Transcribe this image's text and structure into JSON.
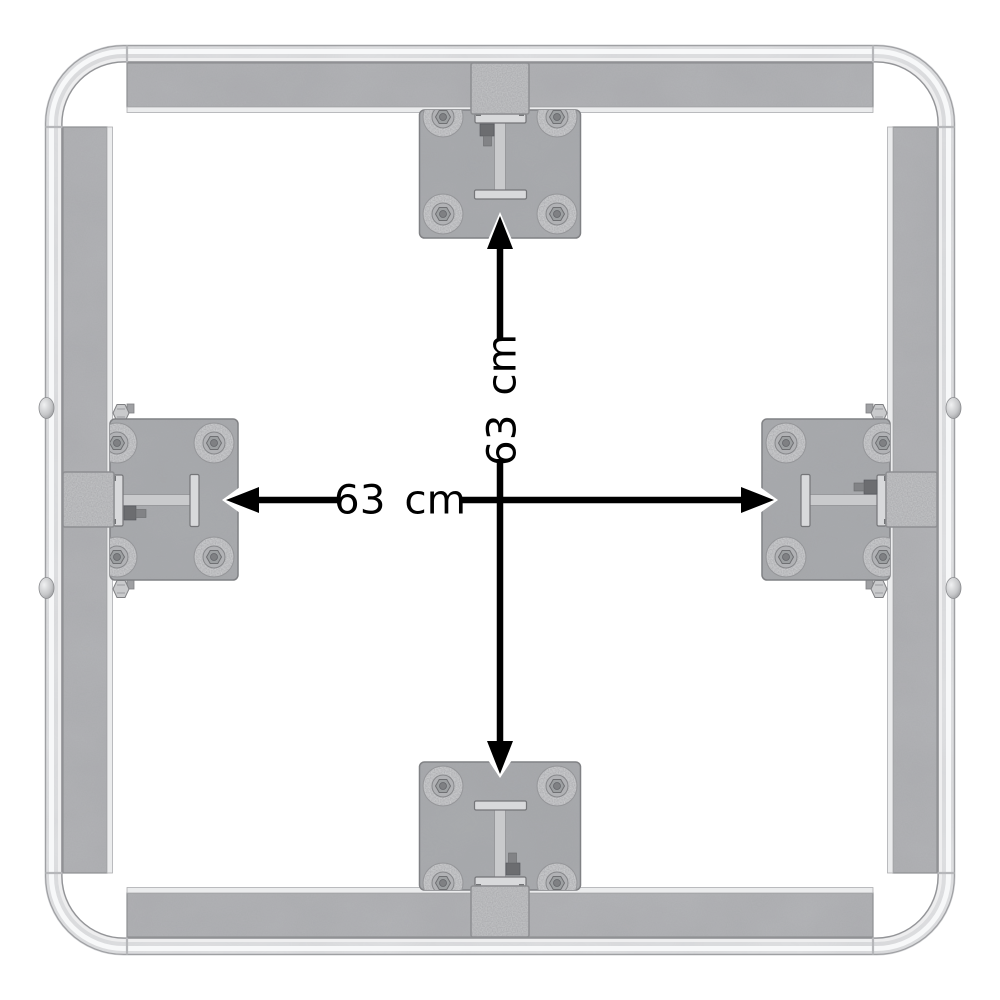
{
  "diagram": {
    "kind": "product-dimension-diagram",
    "subject": "square steel frame top view with four mounting plates",
    "labels": {
      "horizontal": "63 cm",
      "vertical": "63 cm"
    },
    "colors": {
      "background": "#ffffff",
      "annotation": "#000000",
      "metal_tube": "#e2e3e5",
      "metal_tube_highlight": "#f7f8f9",
      "metal_rail": "#b2b3b6",
      "metal_rail_strip": "#ebeced",
      "metal_plate": "#a9abae",
      "metal_clamp": "#bfc0c2",
      "washer_ring": "#c8c9cb"
    }
  }
}
